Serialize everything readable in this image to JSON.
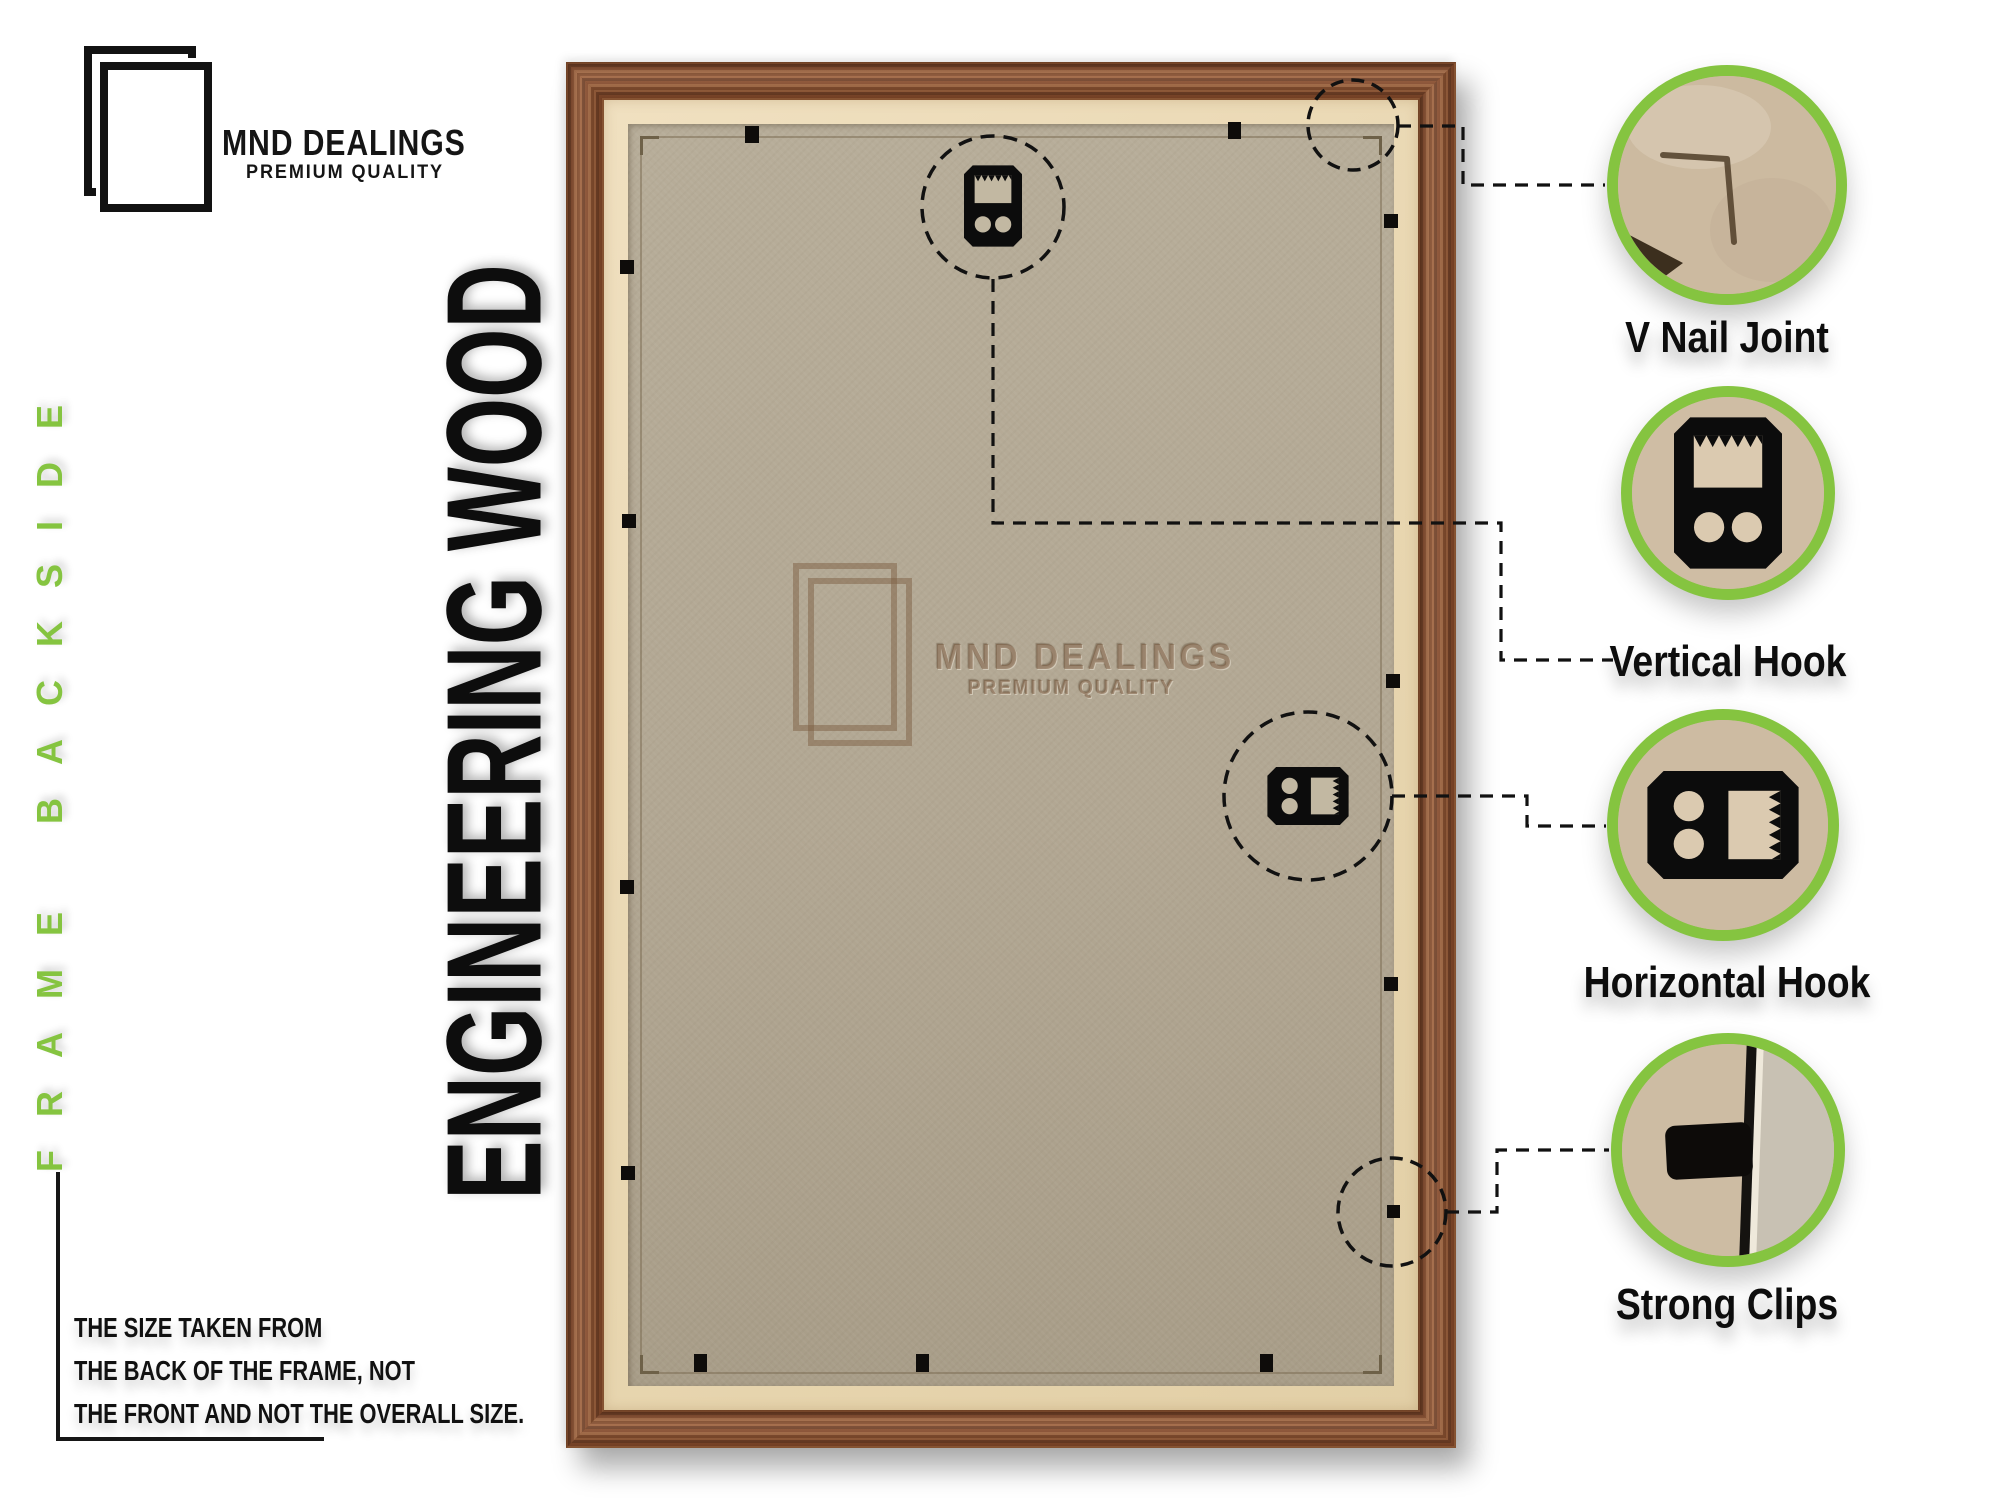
{
  "brand": {
    "name": "MND DEALINGS",
    "tagline": "PREMIUM QUALITY"
  },
  "side_label": "FRAME BACKSIDE",
  "headline": "ENGINEERING WOOD",
  "watermark": {
    "name": "MND DEALINGS",
    "tagline": "PREMIUM QUALITY"
  },
  "note": {
    "lines": [
      "THE SIZE TAKEN FROM",
      "THE BACK OF THE FRAME, NOT",
      "THE FRONT AND NOT THE OVERALL SIZE."
    ]
  },
  "callouts": [
    {
      "id": "v-nail-joint",
      "label": "V Nail Joint"
    },
    {
      "id": "vertical-hook",
      "label": "Vertical Hook"
    },
    {
      "id": "horizontal-hook",
      "label": "Horizontal Hook"
    },
    {
      "id": "strong-clips",
      "label": "Strong Clips"
    }
  ],
  "colors": {
    "accent_green": "#85c440",
    "wood_brown": "#8e4c2b",
    "mat_cream": "#ecdbba",
    "board_tan": "#b3a893",
    "callout_board": "#cdbba2",
    "ink": "#111111"
  }
}
